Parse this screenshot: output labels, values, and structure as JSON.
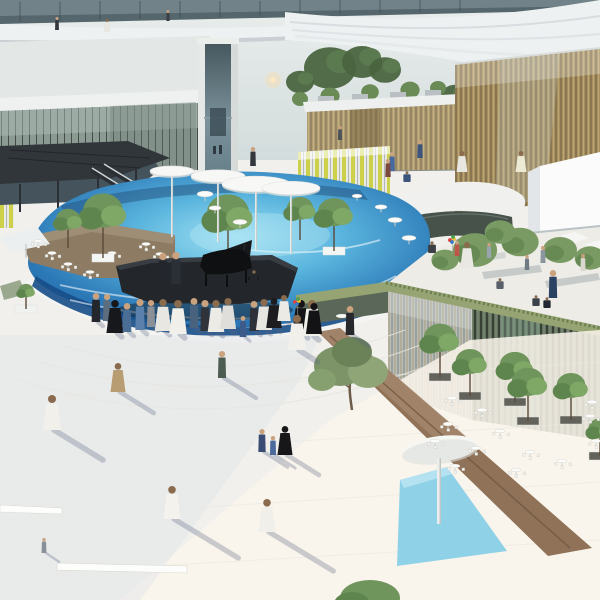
{
  "scene": {
    "type": "architectural-render",
    "description": "Aerial rendering of a plaza: circular blue pool with floating piano stage and white mushroom canopies, glass pavilions, elevated white ring walkway, crowds in white kanduras and black abayas, rooftop terrace garden, triangular bronze planter with olive tree and blue water triangle",
    "palette": {
      "sky": "#dfe6e6",
      "ring-white": "#eef1f2",
      "glass-dark": "#51626a",
      "facade-gold": "#a6905f",
      "facade-dark": "#62725f",
      "pool-deep": "#1b5795",
      "pool-mid": "#3f97cd",
      "pool-bright": "#9fe0f2",
      "plaza": "#f1f0ec",
      "plaza-shade": "#dfe4ea",
      "deck-tan": "#8d7c63",
      "stage-dark": "#23272b",
      "bronze": "#8f7257",
      "triangle-blue": "#8fd2e8",
      "tree-green": "#6f955c",
      "grass-green": "#95a472"
    }
  },
  "background": {
    "trees": [
      [
        100,
        74,
        22
      ],
      [
        128,
        64,
        18
      ],
      [
        152,
        70,
        20
      ],
      [
        182,
        66,
        16
      ],
      [
        205,
        72,
        14
      ],
      [
        330,
        68,
        26
      ],
      [
        362,
        62,
        20
      ],
      [
        385,
        70,
        16
      ],
      [
        300,
        82,
        14
      ],
      [
        455,
        96,
        14
      ],
      [
        472,
        100,
        12
      ],
      [
        488,
        104,
        11
      ],
      [
        60,
        78,
        14
      ],
      [
        35,
        80,
        12
      ]
    ],
    "roof_trees": [
      [
        30,
        98,
        13
      ],
      [
        62,
        94,
        12
      ],
      [
        96,
        102,
        12
      ],
      [
        142,
        98,
        12
      ],
      [
        172,
        106,
        10
      ],
      [
        330,
        96,
        12
      ],
      [
        300,
        99,
        10
      ],
      [
        370,
        92,
        11
      ],
      [
        410,
        90,
        12
      ],
      [
        438,
        88,
        10
      ]
    ]
  },
  "pool": {
    "canopies": [
      [
        172,
        171,
        22
      ],
      [
        218,
        176,
        27
      ],
      [
        256,
        184,
        34
      ],
      [
        291,
        188,
        29
      ]
    ],
    "tables": [
      [
        205,
        194,
        8
      ],
      [
        215,
        208,
        6
      ],
      [
        240,
        222,
        7
      ],
      [
        381,
        207,
        6
      ],
      [
        395,
        220,
        7
      ],
      [
        409,
        238,
        7
      ],
      [
        357,
        196,
        5
      ]
    ],
    "trees": [
      {
        "x": 103,
        "y": 258,
        "h": 66,
        "p": 1
      },
      {
        "x": 228,
        "y": 263,
        "h": 70,
        "p": 1
      },
      {
        "x": 334,
        "y": 251,
        "h": 54,
        "p": 1
      },
      {
        "x": 300,
        "y": 240,
        "h": 44,
        "p": 0
      },
      {
        "x": 68,
        "y": 248,
        "h": 40,
        "p": 0
      }
    ]
  },
  "deck": {
    "tables": [
      [
        38,
        241
      ],
      [
        52,
        253
      ],
      [
        68,
        264
      ],
      [
        90,
        272
      ],
      [
        112,
        253
      ],
      [
        146,
        244
      ],
      [
        160,
        254
      ]
    ]
  },
  "terrace": {
    "trees": [
      [
        475,
        250,
        26
      ],
      [
        520,
        242,
        22
      ],
      [
        560,
        250,
        20
      ],
      [
        590,
        258,
        18
      ],
      [
        445,
        260,
        16
      ],
      [
        500,
        232,
        18
      ]
    ],
    "people": [
      [
        467,
        268,
        26,
        "#eae8e2",
        "robe"
      ],
      [
        457,
        256,
        15,
        "#c0564a",
        "kid"
      ],
      [
        543,
        263,
        17,
        "#8a95a0",
        "slim"
      ],
      [
        553,
        298,
        28,
        "#2b4263",
        "slim"
      ],
      [
        536,
        306,
        13,
        "#3b4148",
        "sit"
      ],
      [
        547,
        308,
        13,
        "#222831",
        "sit"
      ],
      [
        500,
        289,
        13,
        "#59606a",
        "sit"
      ],
      [
        489,
        258,
        15,
        "#9aa4ae",
        "slim"
      ],
      [
        583,
        271,
        17,
        "#d9d7cf",
        "slim"
      ],
      [
        432,
        253,
        14,
        "#3c4045",
        "sit"
      ],
      [
        527,
        270,
        15,
        "#6f7a85",
        "slim"
      ]
    ]
  },
  "stage": {
    "people": [
      [
        163,
        284,
        31,
        "#23262c",
        "slim"
      ],
      [
        176,
        284,
        32,
        "#2b2f36",
        "slim"
      ],
      [
        254,
        282,
        14,
        "#23262b",
        "sit"
      ]
    ]
  },
  "crowd": [
    [
      96,
      322,
      29,
      "#23262b",
      "slim"
    ],
    [
      107,
      321,
      27,
      "#5d6d80",
      "slim"
    ],
    [
      115,
      333,
      33,
      "#17181b",
      "robe"
    ],
    [
      127,
      332,
      29,
      "#4a6d96",
      "slim"
    ],
    [
      140,
      330,
      31,
      "#5b80ab",
      "slim"
    ],
    [
      151,
      327,
      27,
      "#8b8f96",
      "slim"
    ],
    [
      163,
      331,
      32,
      "#e9e7e1",
      "robe"
    ],
    [
      178,
      334,
      34,
      "#f1efe9",
      "robe"
    ],
    [
      194,
      328,
      30,
      "#49637f",
      "slim"
    ],
    [
      205,
      331,
      31,
      "#30343a",
      "slim"
    ],
    [
      216,
      332,
      32,
      "#ecebe5",
      "robe"
    ],
    [
      228,
      329,
      31,
      "#dfdeda",
      "robe"
    ],
    [
      243,
      337,
      21,
      "#3c5a8c",
      "kid"
    ],
    [
      254,
      331,
      30,
      "#2e3238",
      "slim"
    ],
    [
      264,
      330,
      31,
      "#e8e6e0",
      "robe"
    ],
    [
      274,
      328,
      30,
      "#1d1d20",
      "robe"
    ],
    [
      284,
      321,
      26,
      "#eceae4",
      "robe"
    ],
    [
      301,
      334,
      34,
      "#141417",
      "robe"
    ],
    [
      312,
      336,
      36,
      "#f0eee8",
      "robe"
    ]
  ],
  "plaza_people": [
    [
      52,
      430,
      35,
      "#f2f0ea",
      "robe",
      60
    ],
    [
      118,
      392,
      29,
      "#b99d72",
      "robe",
      42
    ],
    [
      222,
      378,
      27,
      "#4c5c50",
      "slim",
      40
    ],
    [
      262,
      452,
      23,
      "#3a4c74",
      "kid",
      30
    ],
    [
      273,
      455,
      19,
      "#4d6a9c",
      "kid",
      26
    ],
    [
      285,
      455,
      29,
      "#17171a",
      "robe",
      40
    ],
    [
      172,
      519,
      33,
      "#f4f2ec",
      "robe",
      78
    ],
    [
      267,
      532,
      33,
      "#f1efe9",
      "robe",
      78
    ],
    [
      44,
      553,
      15,
      "#8a9099",
      "kid",
      18
    ],
    [
      297,
      350,
      35,
      "#f2f0ea",
      "robe",
      24
    ],
    [
      314,
      334,
      31,
      "#131316",
      "robe",
      0
    ],
    [
      350,
      335,
      29,
      "#26282c",
      "slim",
      22
    ],
    [
      392,
      171,
      19,
      "#4868a0",
      "slim",
      0
    ],
    [
      420,
      158,
      18,
      "#3c557c",
      "slim",
      0
    ],
    [
      462,
      172,
      21,
      "#e8e6e0",
      "robe",
      0
    ],
    [
      521,
      172,
      21,
      "#ecead2",
      "robe",
      0
    ],
    [
      407,
      182,
      13,
      "#3c557c",
      "sit",
      0
    ],
    [
      253,
      166,
      19,
      "#33363c",
      "slim",
      0
    ],
    [
      388,
      177,
      18,
      "#7a4a40",
      "slim",
      0
    ],
    [
      57,
      30,
      13,
      "#33383e",
      "slim",
      0
    ],
    [
      107,
      32,
      13,
      "#e8e7e2",
      "robe",
      0
    ],
    [
      168,
      21,
      11,
      "#3a4046",
      "slim",
      0
    ],
    [
      340,
      140,
      14,
      "#4c5458",
      "slim",
      0
    ]
  ],
  "cafe": {
    "tables": [
      [
        452,
        398
      ],
      [
        482,
        410
      ],
      [
        448,
        424
      ],
      [
        500,
        431
      ],
      [
        530,
        452
      ],
      [
        562,
        461
      ],
      [
        590,
        416
      ],
      [
        596,
        441
      ],
      [
        476,
        448
      ],
      [
        516,
        470
      ],
      [
        455,
        466
      ],
      [
        435,
        441
      ],
      [
        592,
        402
      ]
    ],
    "planter_trees": [
      [
        440,
        377,
        34
      ],
      [
        470,
        396,
        30
      ],
      [
        515,
        402,
        32
      ],
      [
        528,
        421,
        34
      ],
      [
        571,
        420,
        30
      ],
      [
        600,
        456,
        24
      ],
      [
        26,
        309,
        16
      ]
    ]
  },
  "balloons": [
    [
      297,
      302
    ],
    [
      452,
      240
    ]
  ],
  "benches": [
    [
      0,
      505,
      62,
      508,
      62,
      514,
      0,
      512
    ],
    [
      57,
      563,
      187,
      566,
      187,
      573,
      57,
      570
    ]
  ]
}
